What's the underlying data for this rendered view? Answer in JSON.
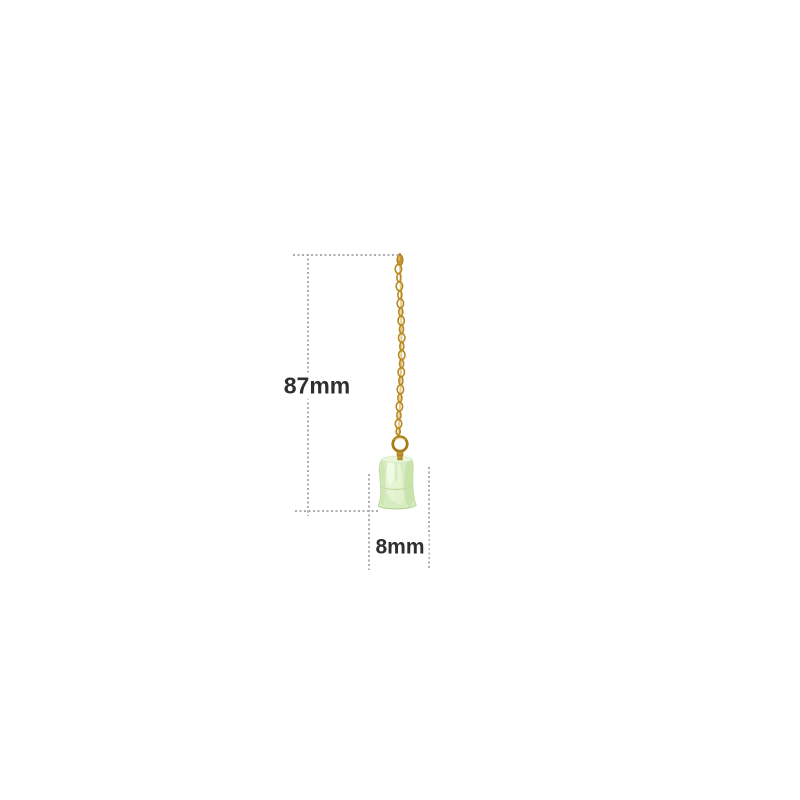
{
  "diagram": {
    "length_label": "87mm",
    "width_label": "8mm"
  },
  "colors": {
    "gold": "#c2942a",
    "gold_dark": "#9a7414",
    "gold_light": "#e3bd5c",
    "jade_base": "#d8ecc2",
    "jade_light": "#ecf7de",
    "jade_shadow": "#c6e0a6",
    "dimension_line": "#aeaeae",
    "label_text": "#2f2f2f",
    "background": "#ffffff"
  }
}
